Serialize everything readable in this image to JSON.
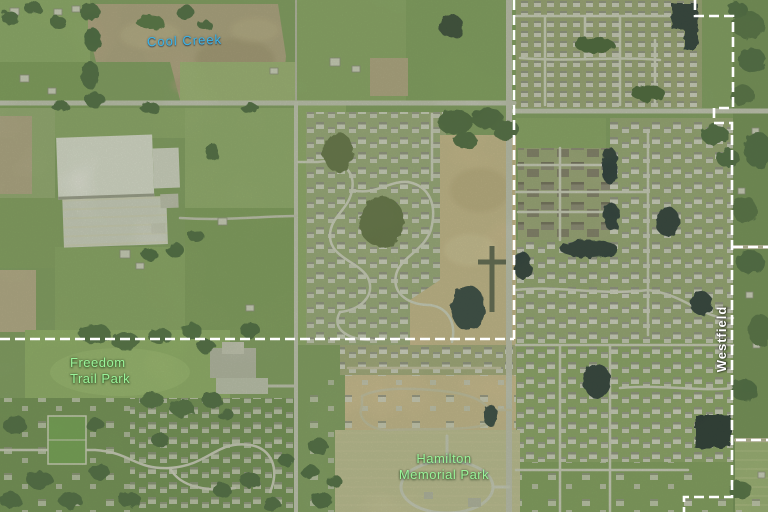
{
  "labels": {
    "cool_creek": {
      "text": "Cool Creek",
      "color": "#38b4ea"
    },
    "freedom_trail_park": {
      "line1": "Freedom",
      "line2": "Trail Park",
      "color": "#9af49a"
    },
    "hamilton_memorial_park": {
      "line1": "Hamilton",
      "line2": "Memorial Park",
      "color": "#9af49a"
    },
    "westfield": {
      "text": "Westfield",
      "color": "#ffffff"
    }
  },
  "boundary": {
    "color": "#ffffff"
  }
}
